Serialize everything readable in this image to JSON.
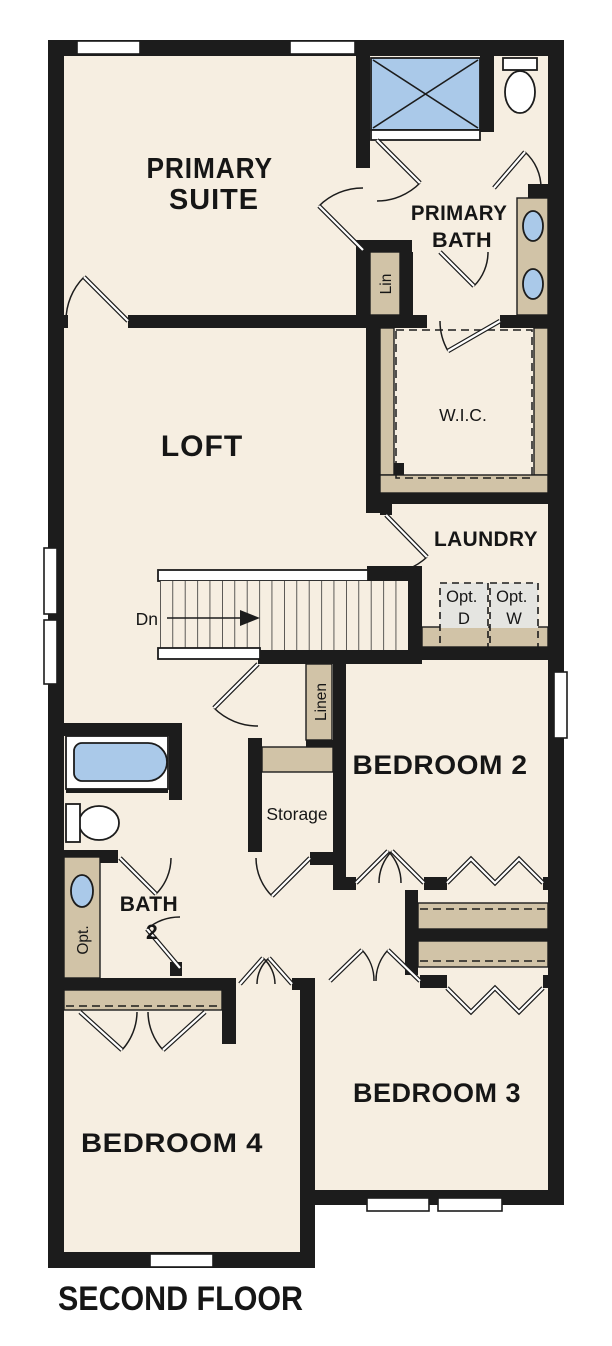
{
  "title": "SECOND FLOOR",
  "colors": {
    "floor": "#f6eee1",
    "wall": "#1c1c1c",
    "fixture": "#aac9e9",
    "counter": "#d1c3a7",
    "appliance": "#e5e5e1",
    "page": "#ffffff"
  },
  "rooms": {
    "primary_suite": {
      "line1": "PRIMARY",
      "line2": "SUITE"
    },
    "loft": {
      "label": "LOFT"
    },
    "primary_bath": {
      "line1": "PRIMARY",
      "line2": "BATH"
    },
    "wic": {
      "label": "W.I.C."
    },
    "laundry": {
      "label": "LAUNDRY"
    },
    "bedroom2": {
      "label": "BEDROOM 2"
    },
    "bedroom3": {
      "label": "BEDROOM 3"
    },
    "bedroom4": {
      "label": "BEDROOM 4"
    },
    "bath2": {
      "line1": "BATH",
      "line2": "2"
    },
    "storage": {
      "label": "Storage"
    },
    "linen": {
      "label": "Linen"
    },
    "lin": {
      "label": "Lin"
    }
  },
  "annotations": {
    "stairs_direction": "Dn",
    "optional_dryer": {
      "line1": "Opt.",
      "line2": "D"
    },
    "optional_washer": {
      "line1": "Opt.",
      "line2": "W"
    },
    "optional_sink": "Opt."
  }
}
